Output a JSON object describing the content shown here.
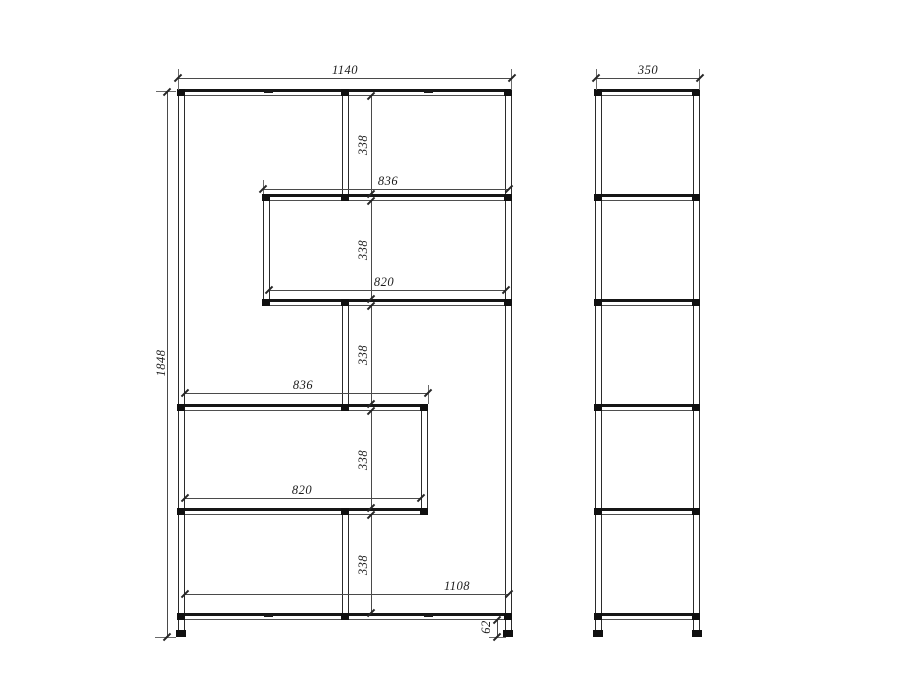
{
  "drawing": {
    "kind": "shelving-unit-two-view-dimension-drawing",
    "dims": {
      "front": {
        "overall_width": "1140",
        "overall_height": "1848",
        "bay_heights": [
          "338",
          "338",
          "338",
          "338",
          "338"
        ],
        "upper_shelf_outer": "836",
        "upper_shelf_inner": "820",
        "lower_shelf_outer": "836",
        "lower_shelf_inner": "820",
        "base_shelf": "1108",
        "leg_height": "62"
      },
      "side": {
        "overall_depth": "350"
      }
    }
  }
}
